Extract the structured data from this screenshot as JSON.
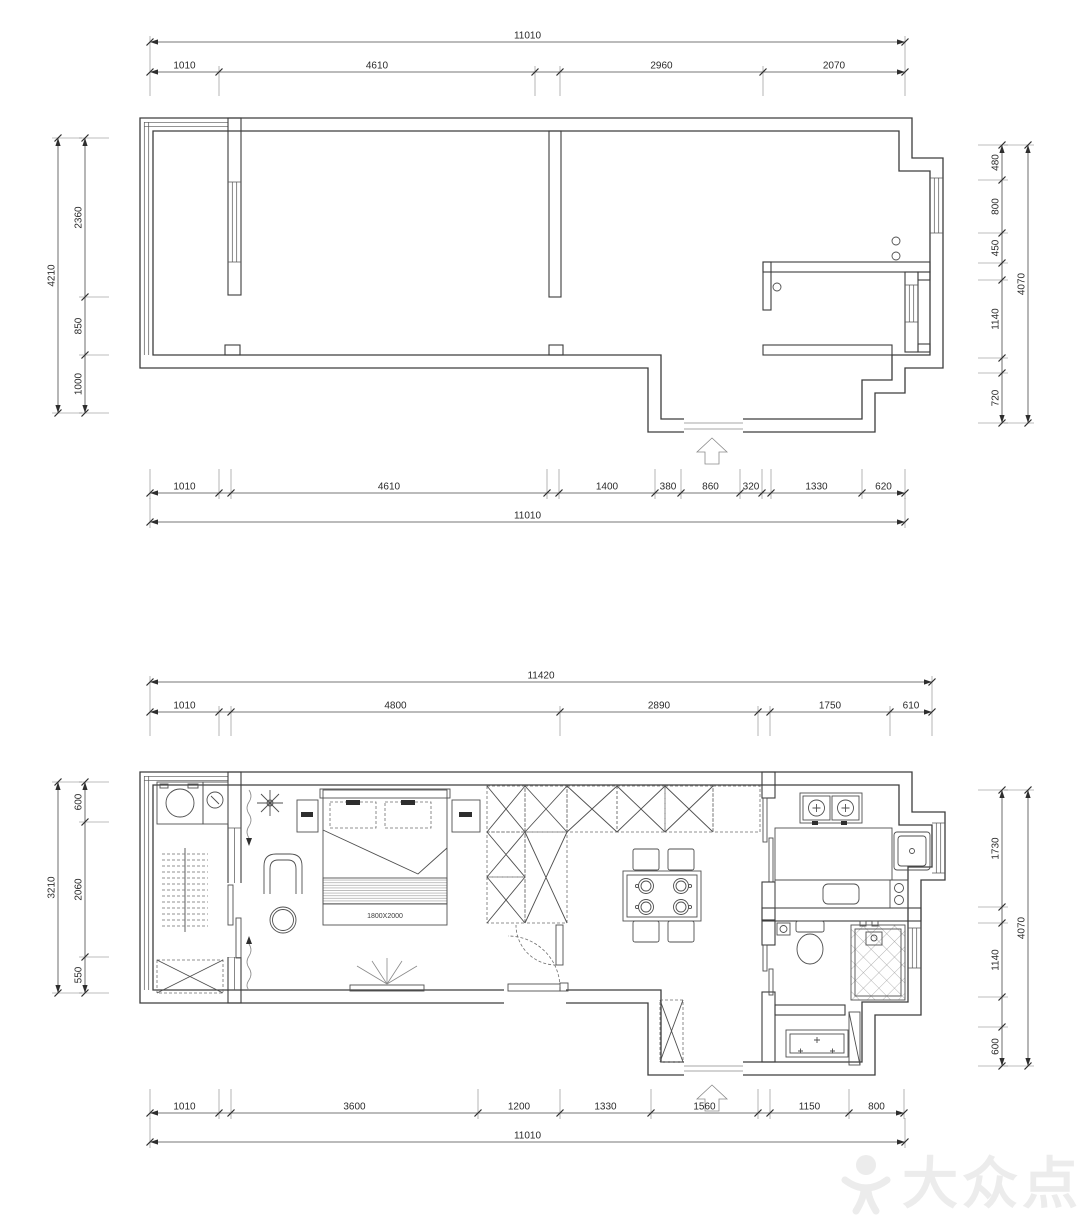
{
  "watermark": {
    "brand_text": "大众点评"
  },
  "plan1": {
    "dims": {
      "top_total": "11010",
      "top": [
        "1010",
        "4610",
        "2960",
        "2070"
      ],
      "left_total": "4210",
      "left": [
        "2360",
        "850",
        "1000"
      ],
      "right_total": "4070",
      "right": [
        "480",
        "800",
        "450",
        "1140",
        "720"
      ],
      "bottom": [
        "1010",
        "4610",
        "1400",
        "380",
        "860",
        "320",
        "1330",
        "620"
      ],
      "bottom_total": "11010"
    }
  },
  "plan2": {
    "bed_label": "1800X2000",
    "dims": {
      "top_total": "11420",
      "top": [
        "1010",
        "4800",
        "2890",
        "1750",
        "610"
      ],
      "left_total": "3210",
      "left": [
        "600",
        "2060",
        "550"
      ],
      "right_total": "4070",
      "right": [
        "1730",
        "1140",
        "600"
      ],
      "bottom": [
        "1010",
        "3600",
        "1200",
        "1330",
        "1560",
        "1150",
        "800"
      ],
      "bottom_total": "11010"
    }
  }
}
